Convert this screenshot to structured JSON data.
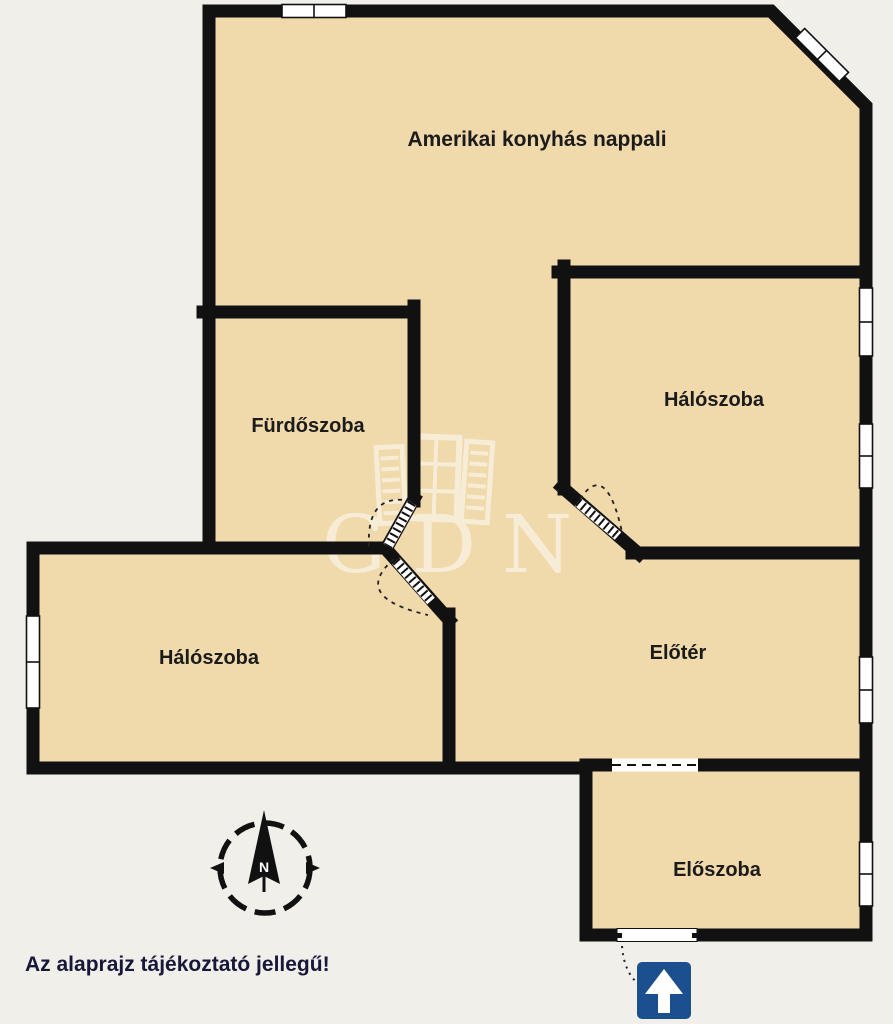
{
  "floorplan": {
    "note": "Az alaprajz tájékoztató jellegű!",
    "watermark_text": "GDN",
    "compass_label": "N",
    "rooms": {
      "living": {
        "name": "Amerikai konyhás nappali"
      },
      "bedroom1": {
        "name": "Hálószoba"
      },
      "bathroom": {
        "name": "Fürdőszoba"
      },
      "bedroom2": {
        "name": "Hálószoba"
      },
      "hall": {
        "name": "Előtér"
      },
      "entry": {
        "name": "Előszoba"
      }
    },
    "colors": {
      "background": "#f1efea",
      "room_fill": "#f0d9ab",
      "wall": "#111111",
      "entrance_arrow_bg": "#1c4f8e",
      "note_text": "#17173a",
      "watermark": "#ffffff"
    }
  }
}
